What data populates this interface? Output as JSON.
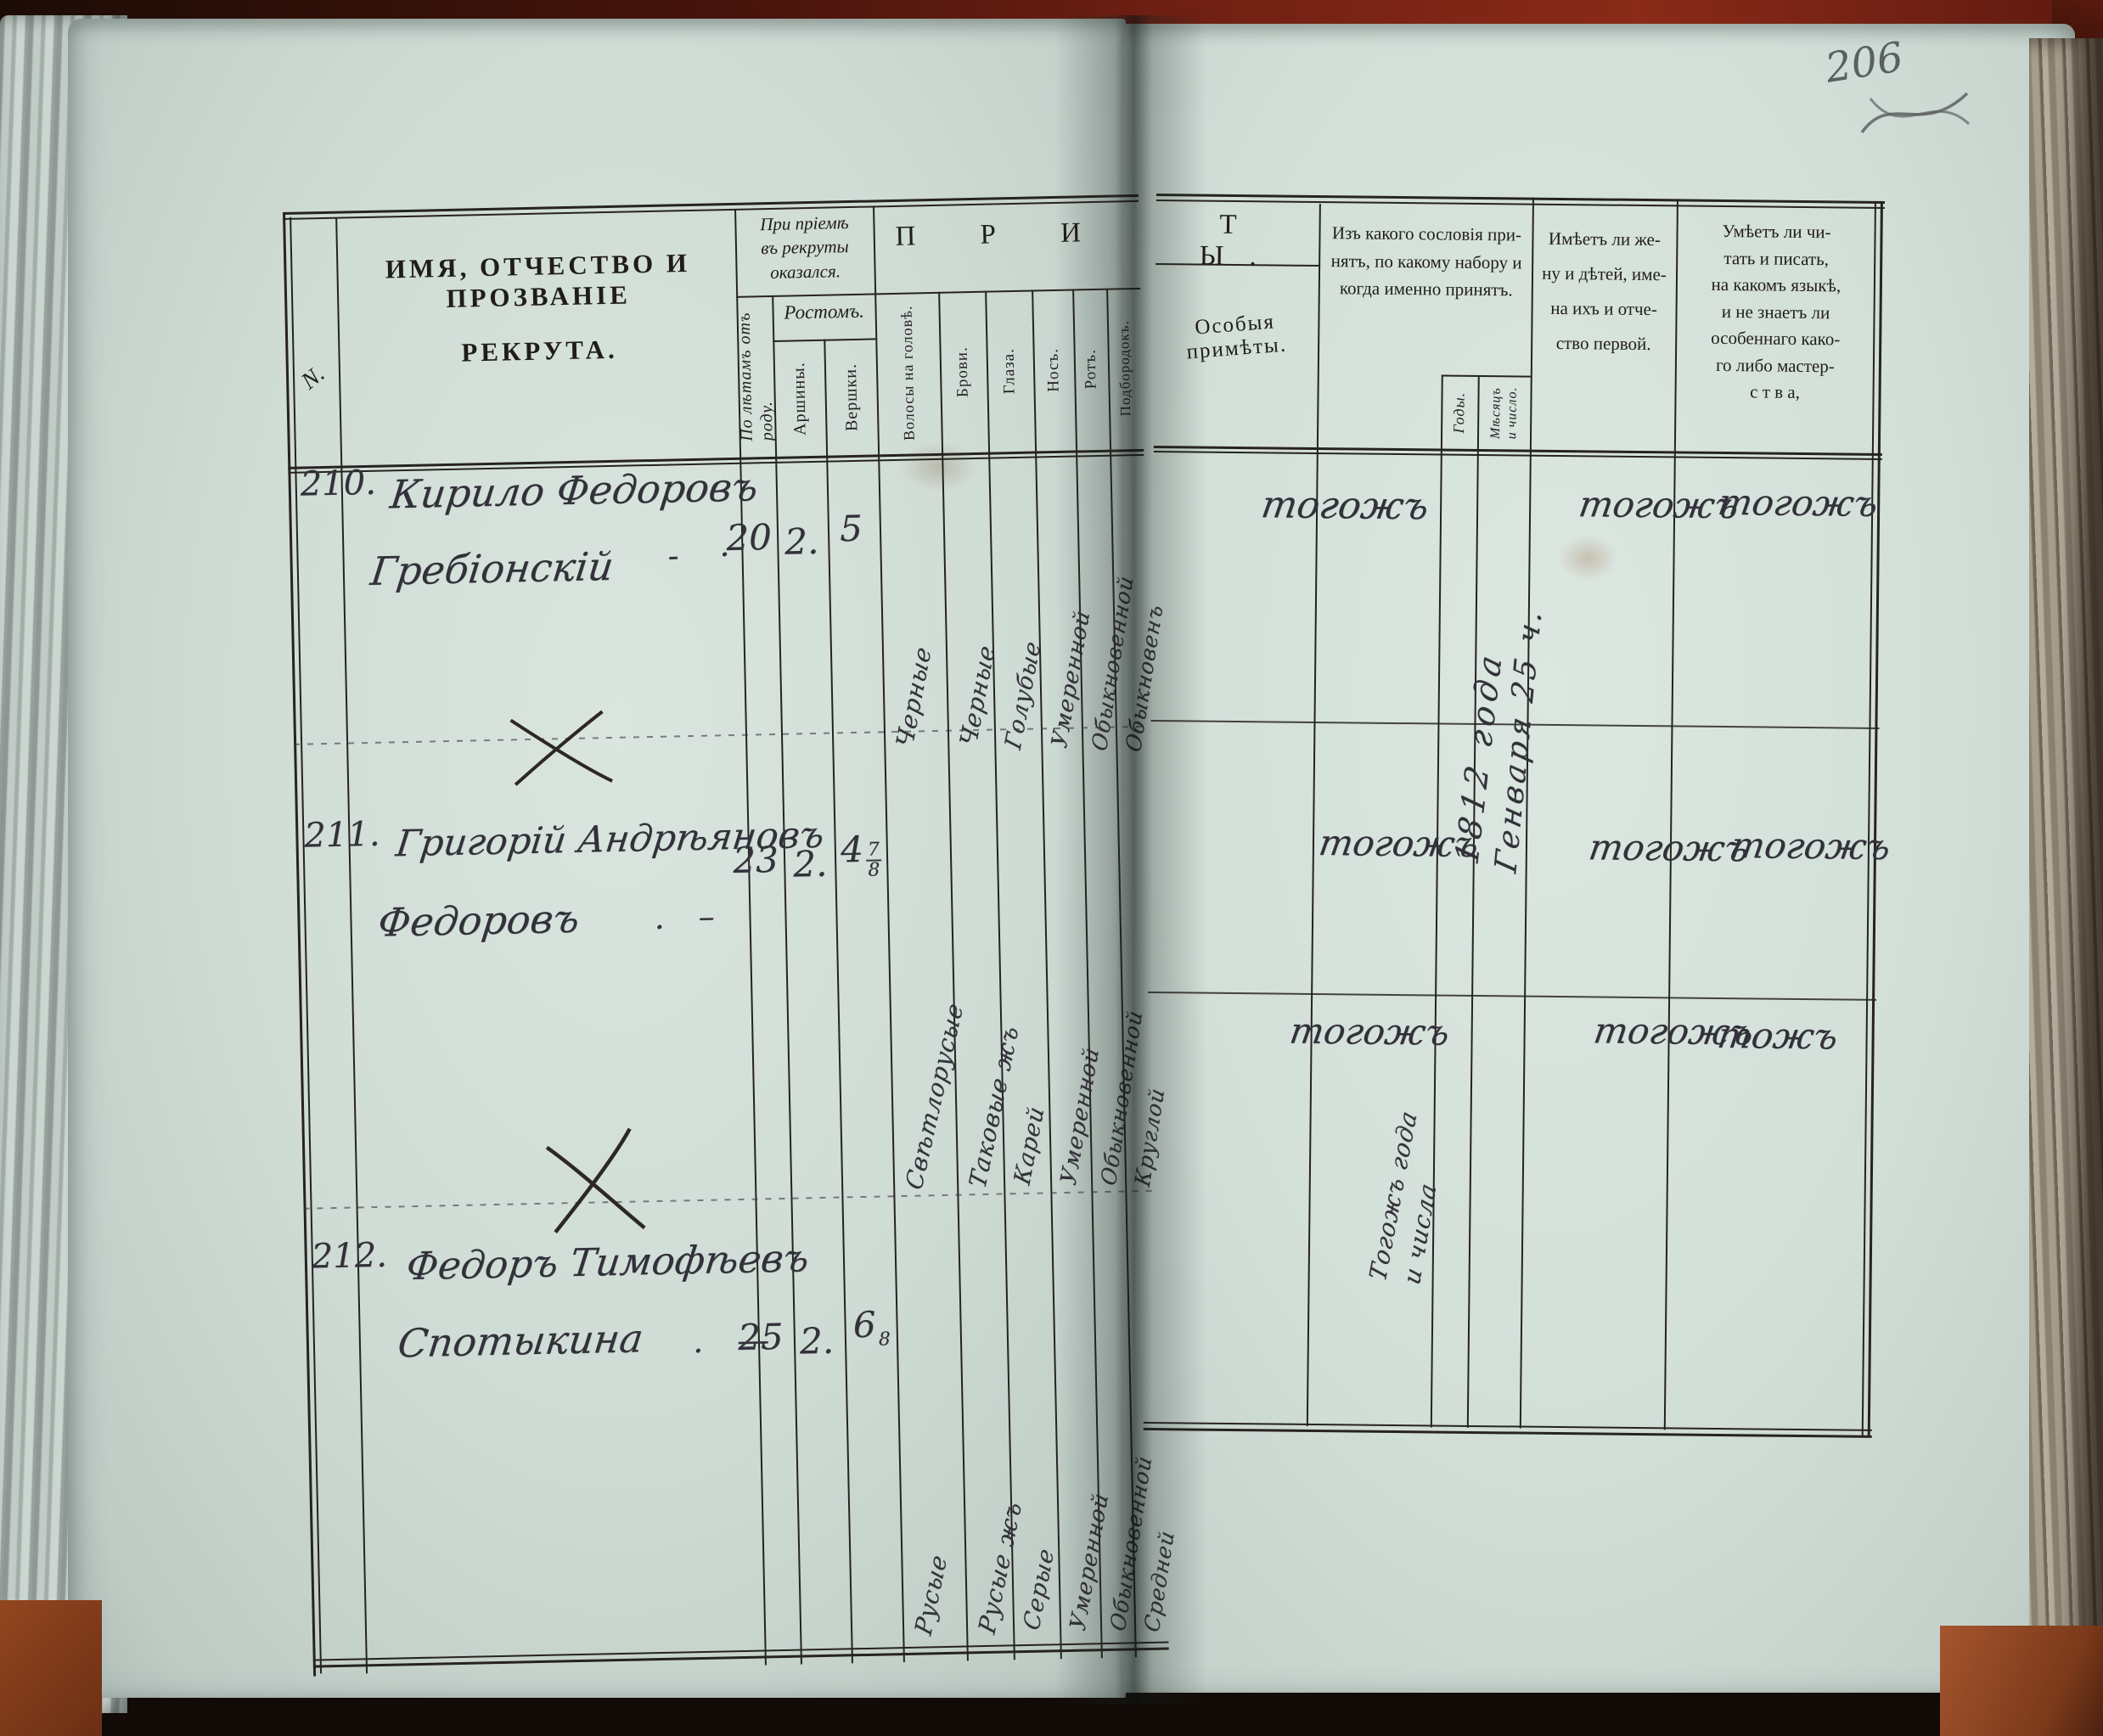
{
  "folio": {
    "number": "206"
  },
  "headers": {
    "row_no": "N.",
    "name_line1": "ИМЯ, ОТЧЕСТВО И ПРОЗВАНІЕ",
    "name_line2": "РЕКРУТА.",
    "acceptance": "При пріемѣ\nвъ рекруты\nоказался.",
    "age": "По лѣтамъ отъ\nроду.",
    "height": "Ростомъ.",
    "arshins": "Аршины.",
    "vershoks": "Вершки.",
    "marks_left": "П Р И",
    "marks_right": "Т Ы.",
    "hair": "Волосы на головѣ.",
    "brows": "Брови.",
    "eyes": "Глаза.",
    "nose": "Носъ.",
    "mouth": "Ротъ.",
    "chin": "Подбородокъ.",
    "special": "Особыя примѣты.",
    "estate": "Изъ какого сословія при-\nнятъ, по какому набору и\nкогда именно принятъ.",
    "years": "Годы.",
    "month_day": "Мѣсяцъ\nи число.",
    "family": "Имѣетъ ли же-\nну и дѣтей, име-\nна ихъ и отче-\nство первой.",
    "literacy": "Умѣетъ ли чи-\nтать и писать,\nна какомъ языкѣ,\nи не знаетъ ли\nособеннаго како-\nго либо мастер-\nс т в а,"
  },
  "rows": [
    {
      "number": "210.",
      "name1": "Кирило Федоровъ",
      "name2": "Гребіонскій",
      "dash": "-  ·",
      "age": "20",
      "arshins": "2.",
      "vershok_main": "5",
      "vershok_num": "",
      "vershok_den": "",
      "hair": "Черные",
      "brows": "Черные",
      "eyes": "Голубые",
      "nose": "Умеренной",
      "mouth": "Обыкновенной",
      "chin": "Обыкновенъ",
      "estate": "тогожъ",
      "family": "тогожъ",
      "literacy": "тогожъ"
    },
    {
      "number": "211.",
      "name1": "Григорій Андрѣяновъ",
      "name2": "Федоровъ",
      "dash": ".    –",
      "age": "23",
      "arshins": "2.",
      "vershok_main": "4",
      "vershok_num": "7",
      "vershok_den": "8",
      "hair": "Свѣтлорусые",
      "brows": "Таковые жъ",
      "eyes": "Карей",
      "nose": "Умеренной",
      "mouth": "Обыкновенной",
      "chin": "Круглой",
      "estate": "тогожъ",
      "family": "тогожъ",
      "literacy": "тогожъ"
    },
    {
      "number": "212.",
      "name1": "Федоръ Тимофѣевъ",
      "name2": "Спотыкина",
      "dash": ".    —",
      "age": "25",
      "arshins": "2.",
      "vershok_main": "6",
      "vershok_num": "",
      "vershok_den": "8",
      "hair": "Русые",
      "brows": "Русые жъ",
      "eyes": "Серые",
      "nose": "Умеренной",
      "mouth": "Обыкновенной",
      "chin": "Средней",
      "estate": "тогожъ",
      "family": "тогожъ",
      "literacy": "тожъ"
    }
  ],
  "notes": {
    "date_a1": "1812 года",
    "date_a2": "Генваря 25 ч.",
    "date_b1": "Тогожъ года",
    "date_b2": "и числа"
  }
}
